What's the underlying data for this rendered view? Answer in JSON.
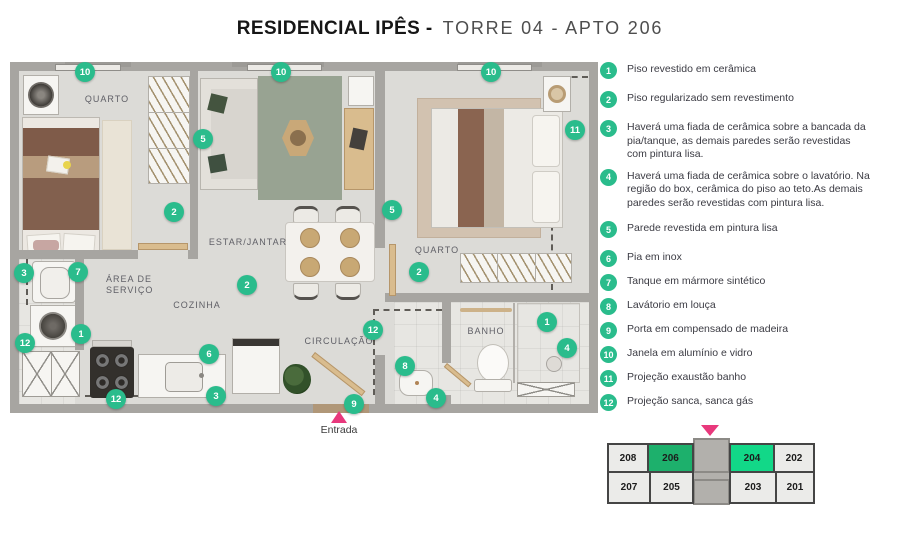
{
  "title": {
    "primary": "RESIDENCIAL IPÊS  -",
    "secondary": "TORRE 04 - APTO 206"
  },
  "colors": {
    "accent_green": "#2abc8c",
    "unit_dark_green": "#1db06c",
    "unit_bright_green": "#12d888",
    "entrance_pink": "#e8387c"
  },
  "plan": {
    "rooms": {
      "quarto_left": "QUARTO",
      "estar_jantar": "ESTAR/JANTAR",
      "quarto_right": "QUARTO",
      "area_servico_line1": "ÁREA DE",
      "area_servico_line2": "SERVIÇO",
      "cozinha": "COZINHA",
      "circulacao": "CIRCULAÇÃO",
      "banho": "BANHO"
    },
    "entrance_label": "Entrada",
    "markers": [
      {
        "label": "10"
      },
      {
        "label": "10"
      },
      {
        "label": "10"
      },
      {
        "label": "5"
      },
      {
        "label": "11"
      },
      {
        "label": "2"
      },
      {
        "label": "5"
      },
      {
        "label": "2"
      },
      {
        "label": "3"
      },
      {
        "label": "7"
      },
      {
        "label": "12"
      },
      {
        "label": "1"
      },
      {
        "label": "2"
      },
      {
        "label": "6"
      },
      {
        "label": "12"
      },
      {
        "label": "3"
      },
      {
        "label": "12"
      },
      {
        "label": "9"
      },
      {
        "label": "8"
      },
      {
        "label": "4"
      },
      {
        "label": "1"
      },
      {
        "label": "4"
      }
    ]
  },
  "legend": {
    "items": [
      {
        "num": "1",
        "text": "Piso revestido em cerâmica"
      },
      {
        "num": "2",
        "text": "Piso regularizado sem revestimento"
      },
      {
        "num": "3",
        "text": "Haverá uma fiada de cerâmica sobre a bancada da pia/tanque, as demais paredes serão revestidas com pintura lisa."
      },
      {
        "num": "4",
        "text": "Haverá uma fiada de cerâmica sobre o lavatório. Na região do box, cerâmica do piso ao teto.As demais paredes serão revestidas com pintura lisa."
      },
      {
        "num": "5",
        "text": "Parede revestida em pintura lisa"
      },
      {
        "num": "6",
        "text": "Pia em inox"
      },
      {
        "num": "7",
        "text": "Tanque em mármore sintético"
      },
      {
        "num": "8",
        "text": "Lavátorio em louça"
      },
      {
        "num": "9",
        "text": "Porta em compensado de madeira"
      },
      {
        "num": "10",
        "text": "Janela em alumínio e vidro"
      },
      {
        "num": "11",
        "text": "Projeção exaustão banho"
      },
      {
        "num": "12",
        "text": "Projeção sanca, sanca gás"
      }
    ]
  },
  "keyplan": {
    "units": [
      {
        "label": "208",
        "highlight": "none"
      },
      {
        "label": "206",
        "highlight": "primary"
      },
      {
        "label": "204",
        "highlight": "secondary"
      },
      {
        "label": "202",
        "highlight": "none"
      },
      {
        "label": "207",
        "highlight": "none"
      },
      {
        "label": "205",
        "highlight": "none"
      },
      {
        "label": "203",
        "highlight": "none"
      },
      {
        "label": "201",
        "highlight": "none"
      }
    ]
  }
}
